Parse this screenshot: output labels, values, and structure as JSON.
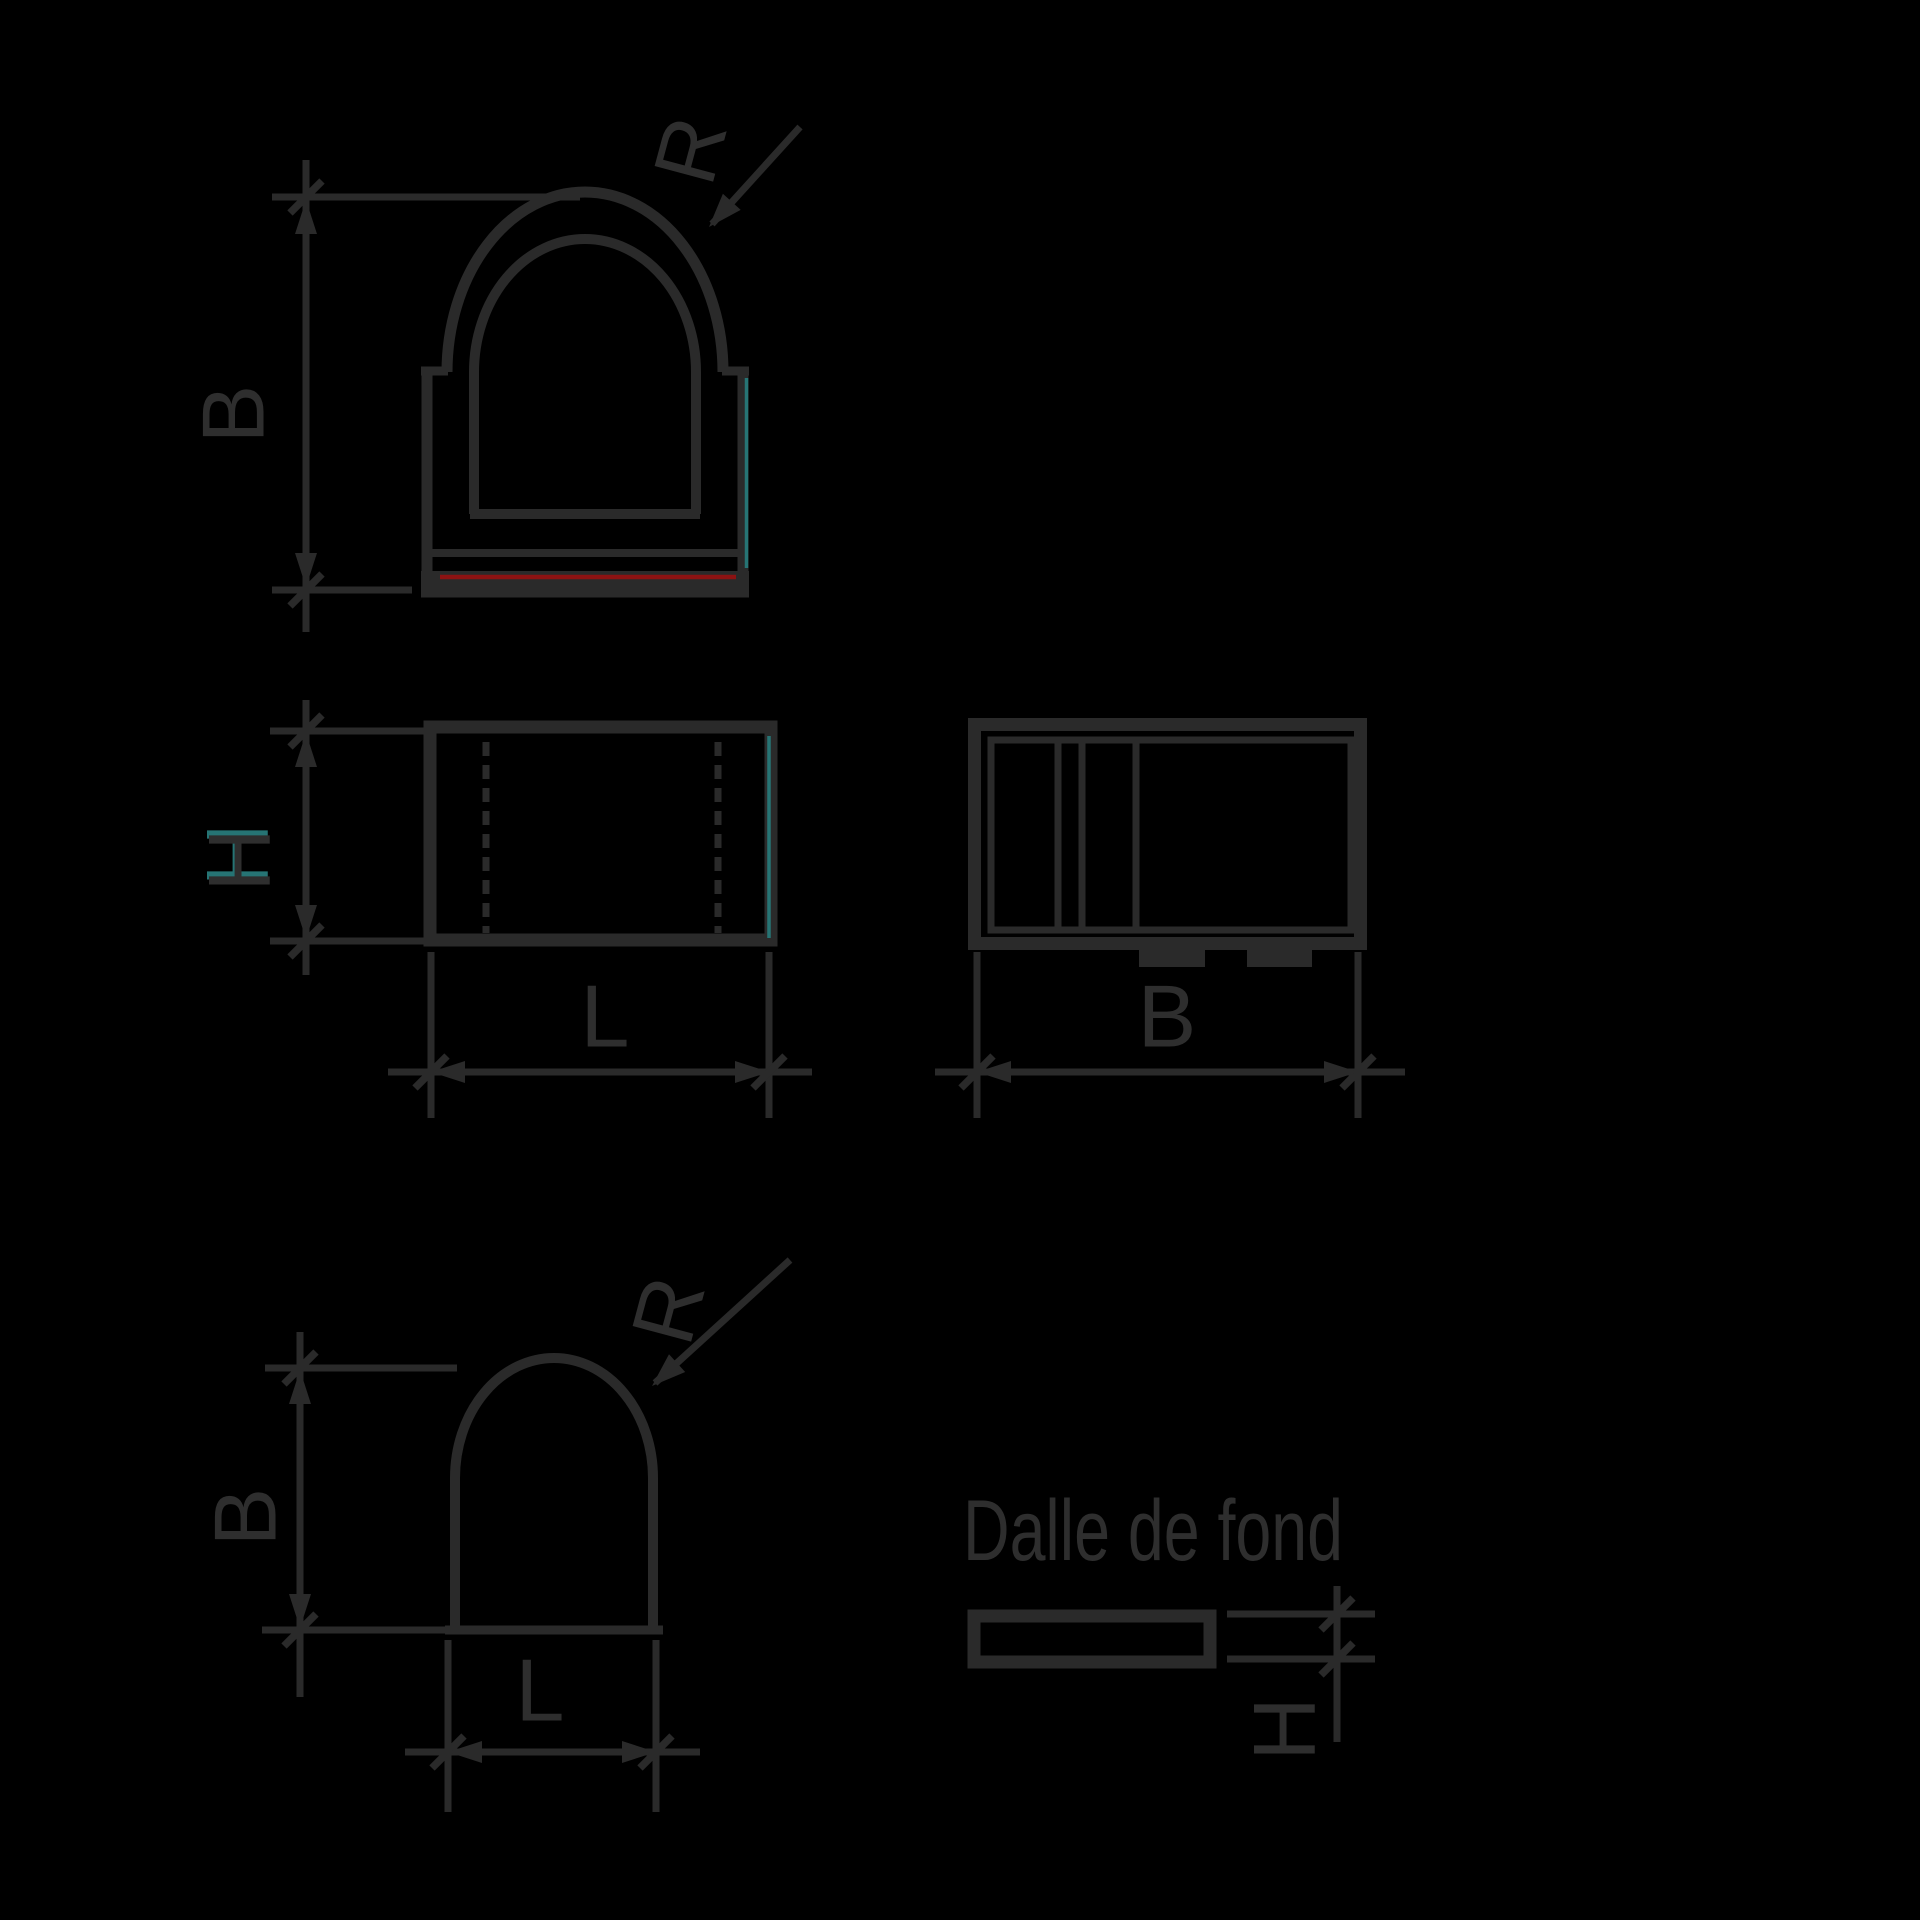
{
  "colors": {
    "background": "#000000",
    "line": "#2a2a2a",
    "text": "#2e2e2e",
    "accent_red": "#8c1212",
    "accent_teal": "#267474"
  },
  "figures": {
    "front_view": {
      "dim_width_label": "B",
      "radius_label": "R"
    },
    "side_view": {
      "dim_height_label": "H",
      "dim_length_label": "L"
    },
    "end_view": {
      "dim_width_label": "B"
    },
    "arch_view": {
      "dim_width_label": "B",
      "radius_label": "R",
      "dim_length_label": "L"
    },
    "slab_view": {
      "title": "Dalle de fond",
      "dim_thickness_label": "H"
    }
  }
}
